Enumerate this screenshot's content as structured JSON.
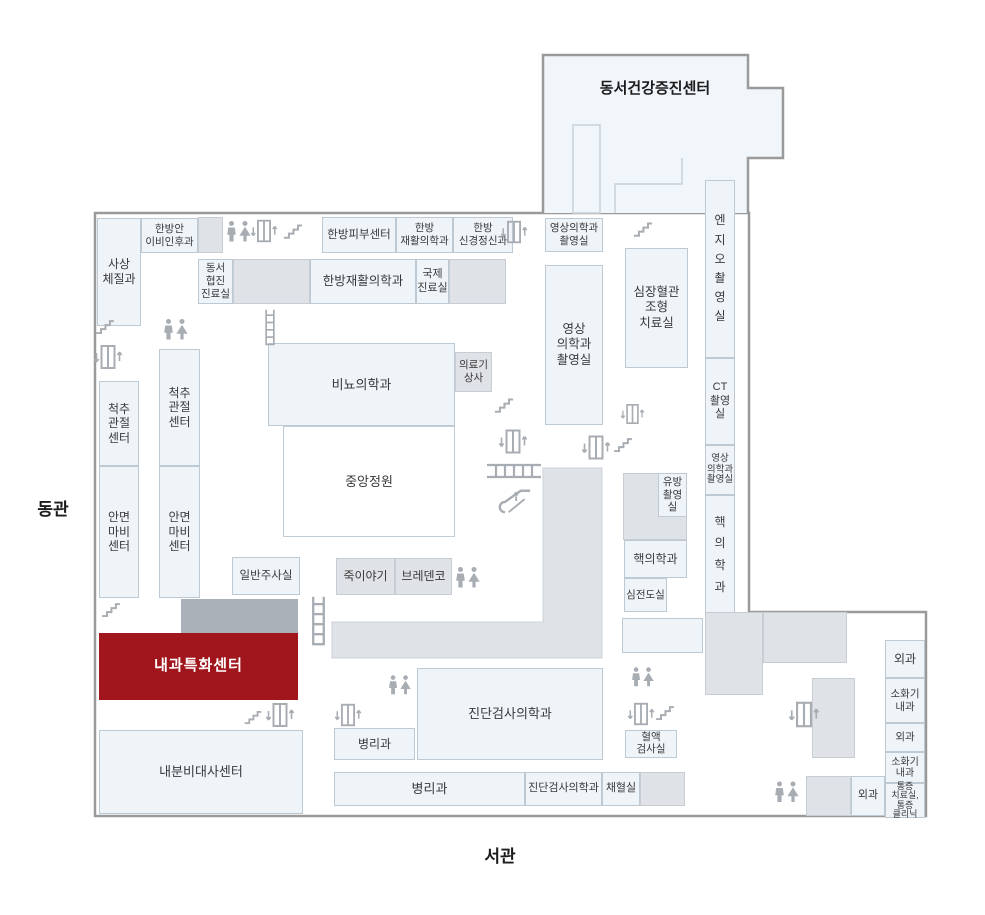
{
  "colors": {
    "accent": "#a0161c",
    "room_fill": "#eff4f9",
    "room_border": "#bdc9d3",
    "gray_fill": "#dfe2e6",
    "gray_border": "#c8cdd3",
    "dark_fill": "#aab0b8",
    "garden_border": "#c3cdd5",
    "building_stroke": "#9a9a9a",
    "top_building_fill": "#f1f6fa",
    "icon_color": "#a8adb3"
  },
  "labels": [
    {
      "name": "east-wing-label",
      "text": "동관",
      "x": 18,
      "y": 492,
      "w": 70,
      "h": 30,
      "fs": 17
    },
    {
      "name": "west-wing-label",
      "text": "서관",
      "x": 450,
      "y": 840,
      "w": 100,
      "h": 28,
      "fs": 17
    },
    {
      "name": "top-building-label",
      "text": "동서건강증진센터",
      "x": 560,
      "y": 70,
      "w": 190,
      "h": 34,
      "fs": 15
    }
  ],
  "rooms": [
    {
      "name": "room-sasang-constitution",
      "label": "사상\n체질과",
      "x": 97,
      "y": 218,
      "w": 44,
      "h": 108,
      "type": "dept",
      "fs": 12
    },
    {
      "name": "room-oriental-ent",
      "label": "한방안\n이비인후과",
      "x": 141,
      "y": 218,
      "w": 57,
      "h": 35,
      "type": "dept",
      "fs": 10.5
    },
    {
      "name": "corridor-block-a",
      "label": "",
      "x": 198,
      "y": 217,
      "w": 25,
      "h": 36,
      "type": "gray",
      "fs": 10
    },
    {
      "name": "room-oriental-skin-center",
      "label": "한방피부센터",
      "x": 322,
      "y": 217,
      "w": 74,
      "h": 36,
      "type": "dept",
      "fs": 11.5
    },
    {
      "name": "room-oriental-rehab-small",
      "label": "한방\n재활의학과",
      "x": 396,
      "y": 217,
      "w": 57,
      "h": 36,
      "type": "dept",
      "fs": 10.5
    },
    {
      "name": "room-oriental-neuropsychiatry",
      "label": "한방\n신경정신과",
      "x": 453,
      "y": 217,
      "w": 60,
      "h": 36,
      "type": "dept",
      "fs": 10.5
    },
    {
      "name": "room-imaging-small-top",
      "label": "영상의학과\n촬영실",
      "x": 545,
      "y": 218,
      "w": 58,
      "h": 34,
      "type": "dept",
      "fs": 10.5
    },
    {
      "name": "room-eastwest-collab-clinic",
      "label": "동서\n협진\n진료실",
      "x": 198,
      "y": 259,
      "w": 35,
      "h": 45,
      "type": "dept",
      "fs": 10.5
    },
    {
      "name": "corridor-block-b",
      "label": "",
      "x": 233,
      "y": 259,
      "w": 77,
      "h": 45,
      "type": "gray",
      "fs": 10
    },
    {
      "name": "room-oriental-rehab-big",
      "label": "한방재활의학과",
      "x": 310,
      "y": 259,
      "w": 106,
      "h": 45,
      "type": "dept",
      "fs": 12.5
    },
    {
      "name": "room-international-clinic",
      "label": "국제\n진료실",
      "x": 416,
      "y": 259,
      "w": 33,
      "h": 45,
      "type": "dept",
      "fs": 11
    },
    {
      "name": "corridor-block-c",
      "label": "",
      "x": 449,
      "y": 259,
      "w": 57,
      "h": 45,
      "type": "gray",
      "fs": 10
    },
    {
      "name": "room-imaging-big",
      "label": "영상\n의학과\n촬영실",
      "x": 545,
      "y": 265,
      "w": 58,
      "h": 160,
      "type": "dept",
      "fs": 12.5
    },
    {
      "name": "room-cardio-angiography",
      "label": "심장혈관\n조형\n치료실",
      "x": 625,
      "y": 248,
      "w": 63,
      "h": 120,
      "type": "dept",
      "fs": 12.5
    },
    {
      "name": "room-angio-suite",
      "label": "엔\n지\n오\n촬\n영\n실",
      "x": 705,
      "y": 180,
      "w": 30,
      "h": 178,
      "type": "dept",
      "fs": 12,
      "lh": 1.6
    },
    {
      "name": "room-ct-suite",
      "label": "CT\n촬영실",
      "x": 705,
      "y": 358,
      "w": 30,
      "h": 87,
      "type": "dept",
      "fs": 11
    },
    {
      "name": "room-imaging-col-small",
      "label": "영상\n의학과\n촬영실",
      "x": 705,
      "y": 445,
      "w": 30,
      "h": 50,
      "type": "dept",
      "fs": 9.5,
      "lh": 1.15
    },
    {
      "name": "room-nuclear-medicine-col",
      "label": "핵\n의\n학\n과",
      "x": 705,
      "y": 495,
      "w": 30,
      "h": 120,
      "type": "dept",
      "fs": 12,
      "lh": 1.8
    },
    {
      "name": "room-spine-joint-center-1",
      "label": "척추\n관절\n센터",
      "x": 99,
      "y": 381,
      "w": 40,
      "h": 85,
      "type": "dept",
      "fs": 12
    },
    {
      "name": "room-spine-joint-center-2",
      "label": "척추\n관절\n센터",
      "x": 159,
      "y": 349,
      "w": 41,
      "h": 117,
      "type": "dept",
      "fs": 12
    },
    {
      "name": "room-facial-palsy-center-1",
      "label": "안면\n마비\n센터",
      "x": 99,
      "y": 466,
      "w": 40,
      "h": 132,
      "type": "dept",
      "fs": 12
    },
    {
      "name": "room-facial-palsy-center-2",
      "label": "안면\n마비\n센터",
      "x": 159,
      "y": 466,
      "w": 41,
      "h": 132,
      "type": "dept",
      "fs": 12
    },
    {
      "name": "room-urology",
      "label": "비뇨의학과",
      "x": 268,
      "y": 343,
      "w": 187,
      "h": 83,
      "type": "dept",
      "fs": 13
    },
    {
      "name": "room-medical-supply-store",
      "label": "의료기\n상사",
      "x": 455,
      "y": 352,
      "w": 37,
      "h": 40,
      "type": "gray",
      "fs": 10.5
    },
    {
      "name": "central-garden",
      "label": "중앙정원",
      "x": 283,
      "y": 426,
      "w": 172,
      "h": 111,
      "type": "garden",
      "fs": 13
    },
    {
      "name": "room-injection-room",
      "label": "일반주사실",
      "x": 232,
      "y": 557,
      "w": 68,
      "h": 38,
      "type": "dept",
      "fs": 11.5
    },
    {
      "name": "shop-juk-story",
      "label": "죽이야기",
      "x": 336,
      "y": 558,
      "w": 59,
      "h": 37,
      "type": "gray",
      "fs": 12
    },
    {
      "name": "shop-bredenko",
      "label": "브레덴코",
      "x": 395,
      "y": 558,
      "w": 57,
      "h": 37,
      "type": "gray",
      "fs": 12
    },
    {
      "name": "corridor-block-breast",
      "label": "",
      "x": 623,
      "y": 473,
      "w": 64,
      "h": 67,
      "type": "gray",
      "fs": 10
    },
    {
      "name": "room-mammography",
      "label": "유방\n촬영실",
      "x": 658,
      "y": 473,
      "w": 29,
      "h": 44,
      "type": "dept",
      "fs": 10.5
    },
    {
      "name": "room-nuclear-medicine",
      "label": "핵의학과",
      "x": 624,
      "y": 540,
      "w": 63,
      "h": 38,
      "type": "dept",
      "fs": 12
    },
    {
      "name": "room-ecg",
      "label": "심전도실",
      "x": 624,
      "y": 578,
      "w": 43,
      "h": 34,
      "type": "dept",
      "fs": 10.5
    },
    {
      "name": "room-unlabeled",
      "label": "",
      "x": 622,
      "y": 618,
      "w": 81,
      "h": 35,
      "type": "dept",
      "fs": 10
    },
    {
      "name": "dark-corridor-bar",
      "label": "",
      "x": 181,
      "y": 599,
      "w": 117,
      "h": 34,
      "type": "dark",
      "fs": 10
    },
    {
      "name": "room-internal-medicine-center",
      "label": "내과특화센터",
      "x": 99,
      "y": 633,
      "w": 199,
      "h": 67,
      "type": "highlight",
      "fs": 15
    },
    {
      "name": "room-endocrine-metabolism-center",
      "label": "내분비대사센터",
      "x": 99,
      "y": 730,
      "w": 204,
      "h": 84,
      "type": "dept",
      "fs": 13
    },
    {
      "name": "room-blood-test",
      "label": "혈액\n검사실",
      "x": 625,
      "y": 730,
      "w": 52,
      "h": 28,
      "type": "dept",
      "fs": 10.5,
      "lh": 1.1
    },
    {
      "name": "room-pathology-small",
      "label": "병리과",
      "x": 334,
      "y": 728,
      "w": 81,
      "h": 32,
      "type": "dept",
      "fs": 12
    },
    {
      "name": "room-diagnostic-lab-big",
      "label": "진단검사의학과",
      "x": 417,
      "y": 668,
      "w": 186,
      "h": 92,
      "type": "dept",
      "fs": 13
    },
    {
      "name": "room-pathology-wide",
      "label": "병리과",
      "x": 334,
      "y": 772,
      "w": 191,
      "h": 34,
      "type": "dept",
      "fs": 13
    },
    {
      "name": "room-diagnostic-lab-small",
      "label": "진단검사의학과",
      "x": 525,
      "y": 772,
      "w": 77,
      "h": 34,
      "type": "dept",
      "fs": 11
    },
    {
      "name": "room-blood-draw",
      "label": "채혈실",
      "x": 602,
      "y": 772,
      "w": 38,
      "h": 34,
      "type": "dept",
      "fs": 11
    },
    {
      "name": "corridor-block-d",
      "label": "",
      "x": 640,
      "y": 772,
      "w": 45,
      "h": 34,
      "type": "gray",
      "fs": 10
    },
    {
      "name": "corridor-block-e",
      "label": "",
      "x": 705,
      "y": 612,
      "w": 58,
      "h": 83,
      "type": "gray",
      "fs": 10
    },
    {
      "name": "corridor-block-f",
      "label": "",
      "x": 763,
      "y": 612,
      "w": 84,
      "h": 51,
      "type": "gray",
      "fs": 10
    },
    {
      "name": "corridor-block-g",
      "label": "",
      "x": 812,
      "y": 678,
      "w": 43,
      "h": 80,
      "type": "gray",
      "fs": 10
    },
    {
      "name": "corridor-block-h",
      "label": "",
      "x": 806,
      "y": 776,
      "w": 45,
      "h": 40,
      "type": "gray",
      "fs": 10
    },
    {
      "name": "room-surgery-1",
      "label": "외과",
      "x": 885,
      "y": 640,
      "w": 40,
      "h": 38,
      "type": "dept",
      "fs": 12
    },
    {
      "name": "room-digestive-1",
      "label": "소화기\n내과",
      "x": 885,
      "y": 678,
      "w": 40,
      "h": 45,
      "type": "dept",
      "fs": 10.5
    },
    {
      "name": "room-surgery-2",
      "label": "외과",
      "x": 885,
      "y": 723,
      "w": 40,
      "h": 29,
      "type": "dept",
      "fs": 10.5
    },
    {
      "name": "room-digestive-2",
      "label": "소화기\n내과",
      "x": 885,
      "y": 752,
      "w": 40,
      "h": 31,
      "type": "dept",
      "fs": 10,
      "lh": 1.1
    },
    {
      "name": "room-pain-clinic",
      "label": "통증\n치료실,\n통증\n클리닉",
      "x": 885,
      "y": 783,
      "w": 40,
      "h": 35,
      "type": "dept",
      "fs": 9,
      "lh": 1.02
    },
    {
      "name": "room-surgery-3",
      "label": "외과",
      "x": 851,
      "y": 776,
      "w": 34,
      "h": 40,
      "type": "dept",
      "fs": 11
    }
  ],
  "icons": [
    {
      "type": "toilet",
      "x": 226,
      "y": 220,
      "w": 26,
      "h": 23
    },
    {
      "type": "elevator",
      "x": 250,
      "y": 217,
      "w": 28,
      "h": 28
    },
    {
      "type": "stairs",
      "x": 283,
      "y": 222,
      "w": 20,
      "h": 17
    },
    {
      "type": "elevator",
      "x": 500,
      "y": 218,
      "w": 28,
      "h": 28
    },
    {
      "type": "stairs",
      "x": 95,
      "y": 318,
      "w": 20,
      "h": 16
    },
    {
      "type": "elevator",
      "x": 93,
      "y": 342,
      "w": 30,
      "h": 30
    },
    {
      "type": "toilet",
      "x": 163,
      "y": 318,
      "w": 26,
      "h": 23
    },
    {
      "type": "stairs",
      "x": 633,
      "y": 220,
      "w": 20,
      "h": 17
    },
    {
      "type": "ladder-v",
      "x": 261,
      "y": 309,
      "w": 18,
      "h": 37
    },
    {
      "type": "stairs",
      "x": 494,
      "y": 396,
      "w": 20,
      "h": 17
    },
    {
      "type": "elevator",
      "x": 498,
      "y": 426,
      "w": 30,
      "h": 31
    },
    {
      "type": "ladder-h",
      "x": 486,
      "y": 461,
      "w": 56,
      "h": 20
    },
    {
      "type": "escalator",
      "x": 498,
      "y": 487,
      "w": 40,
      "h": 28
    },
    {
      "type": "elevator",
      "x": 581,
      "y": 432,
      "w": 30,
      "h": 31
    },
    {
      "type": "stairs",
      "x": 613,
      "y": 436,
      "w": 20,
      "h": 16
    },
    {
      "type": "elevator",
      "x": 620,
      "y": 401,
      "w": 25,
      "h": 26
    },
    {
      "type": "toilet",
      "x": 455,
      "y": 566,
      "w": 26,
      "h": 23
    },
    {
      "type": "ladder-v",
      "x": 309,
      "y": 591,
      "w": 19,
      "h": 60
    },
    {
      "type": "stairs",
      "x": 101,
      "y": 601,
      "w": 20,
      "h": 16
    },
    {
      "type": "stairs",
      "x": 243,
      "y": 709,
      "w": 20,
      "h": 15
    },
    {
      "type": "elevator",
      "x": 265,
      "y": 701,
      "w": 30,
      "h": 28
    },
    {
      "type": "elevator",
      "x": 334,
      "y": 701,
      "w": 28,
      "h": 28
    },
    {
      "type": "toilet",
      "x": 388,
      "y": 674,
      "w": 24,
      "h": 22
    },
    {
      "type": "toilet",
      "x": 631,
      "y": 666,
      "w": 24,
      "h": 22
    },
    {
      "type": "elevator",
      "x": 627,
      "y": 700,
      "w": 28,
      "h": 28
    },
    {
      "type": "stairs",
      "x": 655,
      "y": 704,
      "w": 20,
      "h": 16
    },
    {
      "type": "elevator",
      "x": 788,
      "y": 699,
      "w": 32,
      "h": 31
    },
    {
      "type": "toilet",
      "x": 774,
      "y": 780,
      "w": 26,
      "h": 24
    }
  ]
}
